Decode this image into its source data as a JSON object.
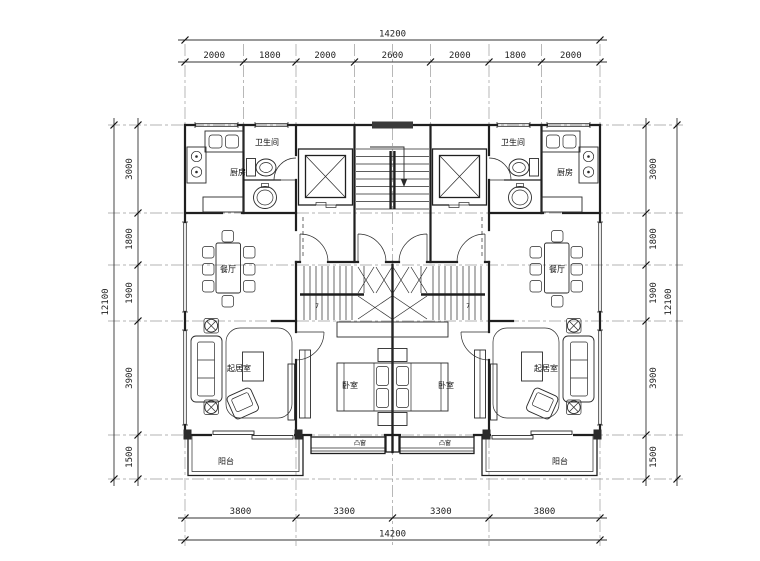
{
  "drawing": {
    "type": "residential-duplex-floor-plan",
    "units": "mm"
  },
  "dimensions": {
    "top": {
      "segments": [
        "2000",
        "1800",
        "2000",
        "2600",
        "2000",
        "1800",
        "2000"
      ],
      "total": "14200"
    },
    "bottom": {
      "segments": [
        "3800",
        "3300",
        "3300",
        "3800"
      ],
      "total": "14200"
    },
    "left": {
      "segments": [
        "3000",
        "1800",
        "1900",
        "3900",
        "1500"
      ],
      "total": "12100"
    },
    "right": {
      "segments": [
        "3000",
        "1800",
        "1900",
        "3900",
        "1500"
      ],
      "total": "12100"
    }
  },
  "rooms": {
    "kitchen": "厨房",
    "bathroom": "卫生间",
    "dining": "餐厅",
    "living": "起居室",
    "bedroom": "卧室",
    "balcony": "阳台",
    "bay_window": "凸窗"
  },
  "marks": {
    "stair_step_count": "7"
  },
  "icons": {
    "elevator": "elevator-shaft-x-icon",
    "stair_arrow": "stair-direction-arrow-icon"
  },
  "colors": {
    "background": "#ffffff",
    "wall_line": "#1f1f1f",
    "axis_line": "#9a9a9a",
    "dimension_text": "#222222",
    "window_band": "#3a3a3a"
  }
}
